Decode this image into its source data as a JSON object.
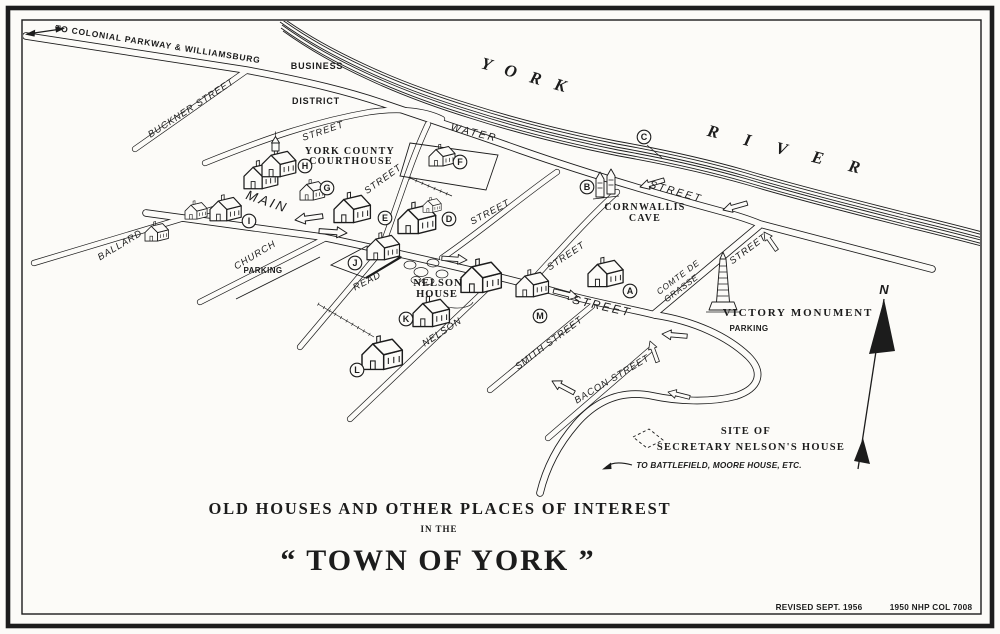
{
  "colors": {
    "ink": "#1c1c1c",
    "paper": "#fcfbf8"
  },
  "map": {
    "annotations": {
      "to_parkway": "TO COLONIAL PARKWAY & WILLIAMSBURG",
      "business": "BUSINESS",
      "district": "DISTRICT",
      "to_battlefield": "TO BATTLEFIELD, MOORE HOUSE, ETC.",
      "north": "N"
    },
    "river": {
      "york": "Y O R K",
      "river": "R I V E R"
    },
    "streets": {
      "buckner": "BUCKNER STREET",
      "main": "MAIN",
      "church": "CHURCH",
      "ballard": "BALLARD",
      "read": "READ",
      "nelson": "NELSON",
      "smith": "SMITH STREET",
      "bacon": "BACON STREET",
      "water": "WATER",
      "street": "STREET",
      "comte_line1": "COMTE DE",
      "comte_line2": "GRASSE",
      "parking": "PARKING"
    },
    "places": {
      "courthouse_line1": "YORK COUNTY",
      "courthouse_line2": "COURTHOUSE",
      "cornwallis_line1": "CORNWALLIS",
      "cornwallis_line2": "CAVE",
      "nelson_house_line1": "NELSON",
      "nelson_house_line2": "HOUSE",
      "victory_monument": "VICTORY MONUMENT",
      "site_line1": "SITE OF",
      "site_line2": "SECRETARY NELSON'S HOUSE"
    },
    "markers": [
      "A",
      "B",
      "C",
      "D",
      "E",
      "F",
      "G",
      "H",
      "I",
      "J",
      "K",
      "L",
      "M"
    ]
  },
  "title": {
    "line1": "OLD HOUSES AND OTHER PLACES OF INTEREST",
    "line2": "IN THE",
    "line3": "“ TOWN OF YORK ”"
  },
  "credits": {
    "revised": "REVISED SEPT. 1956",
    "catalog": "1950 NHP COL 7008"
  }
}
